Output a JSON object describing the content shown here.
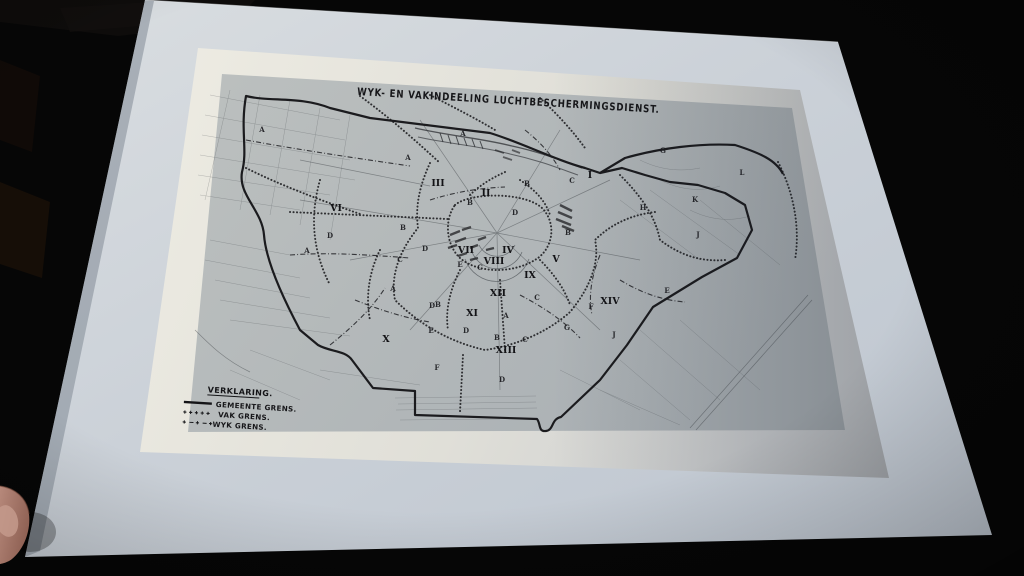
{
  "photo": {
    "colors": {
      "background": "#060606",
      "mat_paper": "#c9cfd6",
      "print_sheet": "#e6e4db",
      "map_background": "#b4b8b9",
      "map_ink": "#1d1d20",
      "finger_skin": "#a5756a",
      "finger_nail": "#c49a8c"
    }
  },
  "map": {
    "title": "WYK- EN VAKINDEELING LUCHTBESCHERMINGSDIENST.",
    "legend": {
      "heading": "VERKLARING.",
      "items": [
        {
          "symbol": "solid-line",
          "label": "GEMEENTE GRENS."
        },
        {
          "symbol": "plus-line",
          "label": "VAK GRENS."
        },
        {
          "symbol": "plus-dash-line",
          "label": "WYK GRENS."
        }
      ]
    },
    "district_numerals": [
      {
        "label": "I",
        "x": 590,
        "y": 178
      },
      {
        "label": "II",
        "x": 486,
        "y": 196
      },
      {
        "label": "III",
        "x": 438,
        "y": 186
      },
      {
        "label": "IV",
        "x": 508,
        "y": 253
      },
      {
        "label": "V",
        "x": 556,
        "y": 262
      },
      {
        "label": "VI",
        "x": 336,
        "y": 211
      },
      {
        "label": "VII",
        "x": 466,
        "y": 253
      },
      {
        "label": "VIII",
        "x": 494,
        "y": 264
      },
      {
        "label": "IX",
        "x": 530,
        "y": 278
      },
      {
        "label": "X",
        "x": 386,
        "y": 342
      },
      {
        "label": "XI",
        "x": 472,
        "y": 316
      },
      {
        "label": "XII",
        "x": 498,
        "y": 296
      },
      {
        "label": "XIII",
        "x": 506,
        "y": 353
      },
      {
        "label": "XIV",
        "x": 610,
        "y": 304
      }
    ],
    "section_letters": [
      {
        "label": "A",
        "x": 463,
        "y": 136
      },
      {
        "label": "A",
        "x": 408,
        "y": 160
      },
      {
        "label": "A",
        "x": 307,
        "y": 253
      },
      {
        "label": "A",
        "x": 393,
        "y": 291
      },
      {
        "label": "A",
        "x": 506,
        "y": 318
      },
      {
        "label": "A",
        "x": 262,
        "y": 132
      },
      {
        "label": "B",
        "x": 527,
        "y": 186
      },
      {
        "label": "B",
        "x": 403,
        "y": 230
      },
      {
        "label": "B",
        "x": 497,
        "y": 340
      },
      {
        "label": "B",
        "x": 568,
        "y": 235
      },
      {
        "label": "B",
        "x": 470,
        "y": 205
      },
      {
        "label": "B",
        "x": 438,
        "y": 307
      },
      {
        "label": "C",
        "x": 572,
        "y": 183
      },
      {
        "label": "C",
        "x": 400,
        "y": 262
      },
      {
        "label": "C",
        "x": 525,
        "y": 342
      },
      {
        "label": "C",
        "x": 480,
        "y": 270
      },
      {
        "label": "C",
        "x": 537,
        "y": 300
      },
      {
        "label": "D",
        "x": 425,
        "y": 251
      },
      {
        "label": "D",
        "x": 466,
        "y": 333
      },
      {
        "label": "D",
        "x": 502,
        "y": 382
      },
      {
        "label": "D",
        "x": 515,
        "y": 215
      },
      {
        "label": "D",
        "x": 432,
        "y": 308
      },
      {
        "label": "D",
        "x": 330,
        "y": 238
      },
      {
        "label": "E",
        "x": 431,
        "y": 333
      },
      {
        "label": "E",
        "x": 667,
        "y": 293
      },
      {
        "label": "E",
        "x": 460,
        "y": 267
      },
      {
        "label": "F",
        "x": 437,
        "y": 370
      },
      {
        "label": "F",
        "x": 591,
        "y": 309
      },
      {
        "label": "G",
        "x": 567,
        "y": 330
      },
      {
        "label": "G",
        "x": 663,
        "y": 153
      },
      {
        "label": "H",
        "x": 643,
        "y": 210
      },
      {
        "label": "J",
        "x": 614,
        "y": 337
      },
      {
        "label": "J",
        "x": 698,
        "y": 237
      },
      {
        "label": "K",
        "x": 695,
        "y": 202
      },
      {
        "label": "L",
        "x": 742,
        "y": 175
      }
    ]
  }
}
